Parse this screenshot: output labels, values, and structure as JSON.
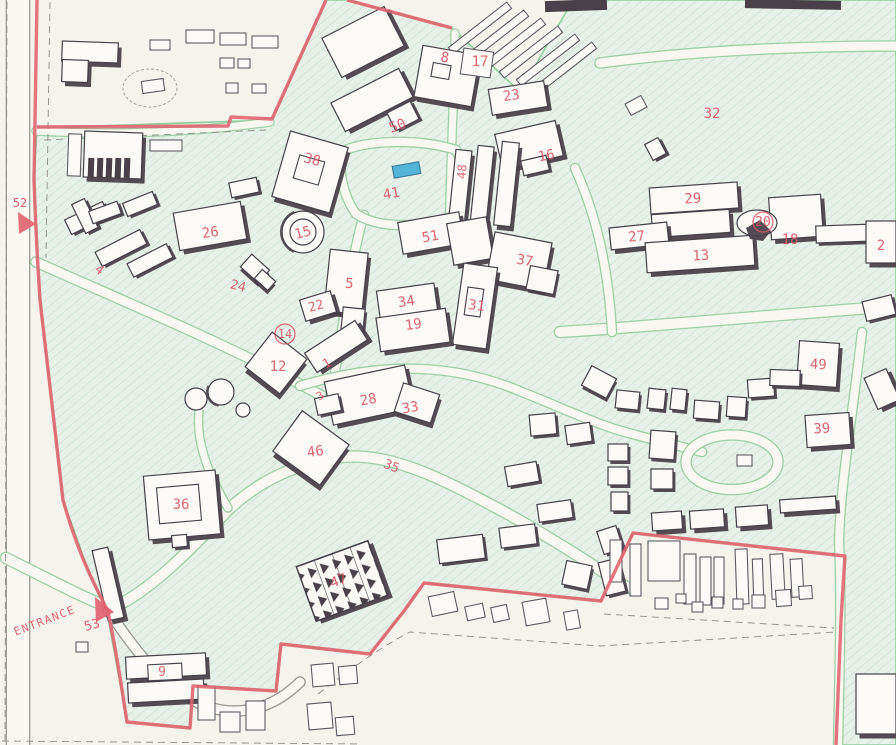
{
  "map": {
    "kind": "scanned campus site map",
    "entrance_label": "ENTRANCE",
    "labels": [
      {
        "t": "52",
        "x": 20,
        "y": 207,
        "r": 0,
        "s": 12
      },
      {
        "t": "4",
        "x": 97,
        "y": 273,
        "r": 38,
        "s": 13
      },
      {
        "t": "ENTRANCE",
        "x": 46,
        "y": 624,
        "r": -21,
        "s": 11,
        "sp": 1.5
      },
      {
        "t": "53",
        "x": 93,
        "y": 629,
        "r": -15,
        "s": 13
      },
      {
        "t": "9",
        "x": 162,
        "y": 676,
        "r": 0,
        "s": 13
      },
      {
        "t": "36",
        "x": 181,
        "y": 509,
        "r": 0,
        "s": 14
      },
      {
        "t": "47",
        "x": 340,
        "y": 585,
        "r": -20,
        "s": 14
      },
      {
        "t": "35",
        "x": 390,
        "y": 470,
        "r": 22,
        "s": 13
      },
      {
        "t": "46",
        "x": 316,
        "y": 456,
        "r": -8,
        "s": 14
      },
      {
        "t": "28",
        "x": 369,
        "y": 404,
        "r": -10,
        "s": 14
      },
      {
        "t": "33",
        "x": 411,
        "y": 412,
        "r": -10,
        "s": 14
      },
      {
        "t": "12",
        "x": 278,
        "y": 371,
        "r": 0,
        "s": 14
      },
      {
        "t": "14",
        "x": 285,
        "y": 338,
        "r": 0,
        "s": 12,
        "c": 1
      },
      {
        "t": "1",
        "x": 329,
        "y": 367,
        "r": -30,
        "s": 13
      },
      {
        "t": "3",
        "x": 322,
        "y": 399,
        "r": -30,
        "s": 11
      },
      {
        "t": "24",
        "x": 237,
        "y": 290,
        "r": 15,
        "s": 13
      },
      {
        "t": "26",
        "x": 211,
        "y": 237,
        "r": -8,
        "s": 14
      },
      {
        "t": "15",
        "x": 304,
        "y": 237,
        "r": -15,
        "s": 14
      },
      {
        "t": "38",
        "x": 311,
        "y": 164,
        "r": 15,
        "s": 14
      },
      {
        "t": "50",
        "x": 399,
        "y": 130,
        "r": -20,
        "s": 14
      },
      {
        "t": "41",
        "x": 392,
        "y": 198,
        "r": -10,
        "s": 14
      },
      {
        "t": "5",
        "x": 349,
        "y": 288,
        "r": 5,
        "s": 14
      },
      {
        "t": "22",
        "x": 317,
        "y": 310,
        "r": -15,
        "s": 13
      },
      {
        "t": "34",
        "x": 407,
        "y": 306,
        "r": -8,
        "s": 14
      },
      {
        "t": "19",
        "x": 414,
        "y": 329,
        "r": -8,
        "s": 14
      },
      {
        "t": "31",
        "x": 476,
        "y": 310,
        "r": 8,
        "s": 14
      },
      {
        "t": "37",
        "x": 524,
        "y": 265,
        "r": 10,
        "s": 14
      },
      {
        "t": "51",
        "x": 431,
        "y": 241,
        "r": -10,
        "s": 14
      },
      {
        "t": "48",
        "x": 466,
        "y": 172,
        "r": -85,
        "s": 12
      },
      {
        "t": "8",
        "x": 444,
        "y": 62,
        "r": 10,
        "s": 14
      },
      {
        "t": "17",
        "x": 480,
        "y": 66,
        "r": 0,
        "s": 14
      },
      {
        "t": "23",
        "x": 512,
        "y": 100,
        "r": -8,
        "s": 14
      },
      {
        "t": "16",
        "x": 547,
        "y": 160,
        "r": -10,
        "s": 14
      },
      {
        "t": "32",
        "x": 712,
        "y": 118,
        "r": 0,
        "s": 14
      },
      {
        "t": "29",
        "x": 693,
        "y": 203,
        "r": -3,
        "s": 14
      },
      {
        "t": "27",
        "x": 637,
        "y": 241,
        "r": -5,
        "s": 14
      },
      {
        "t": "13",
        "x": 701,
        "y": 260,
        "r": -3,
        "s": 14
      },
      {
        "t": "20",
        "x": 763,
        "y": 226,
        "r": 0,
        "s": 13,
        "c": 1
      },
      {
        "t": "18",
        "x": 790,
        "y": 244,
        "r": 0,
        "s": 14
      },
      {
        "t": "2",
        "x": 881,
        "y": 250,
        "r": 0,
        "s": 14
      },
      {
        "t": "49",
        "x": 818,
        "y": 369,
        "r": 3,
        "s": 14
      },
      {
        "t": "39",
        "x": 822,
        "y": 433,
        "r": -3,
        "s": 14
      }
    ],
    "colors": {
      "paper": "#f5f3ec",
      "campus": "#e8f1e9",
      "hatchline": "#c2dcc9",
      "greenedge": "#8ecf9b",
      "roadfill": "#f8f7f2",
      "roadcase": "#9fcfa6",
      "graycase": "#9c9b94",
      "bfill": "#fbfaf6",
      "bstroke": "#46404a",
      "bshadow": "#4a4049",
      "red": "#e0616e",
      "redtext": "#dc5a66",
      "pool": "#54b4d8",
      "dashc": "#8f8e88"
    }
  }
}
